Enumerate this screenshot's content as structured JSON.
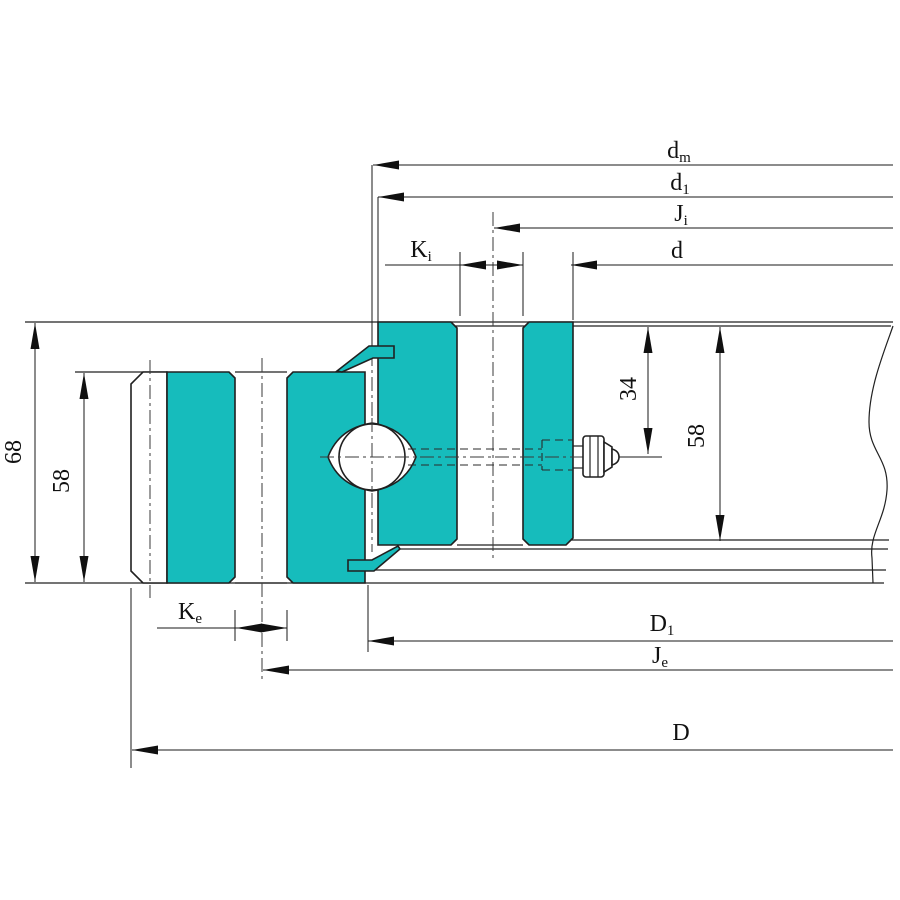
{
  "meta": {
    "title": "Slewing ring bearing cross-section drawing",
    "description": "Half-section engineering drawing of a single-row ball slewing bearing with teal inner and outer rings, rolling ball, top and bottom seals, grease fitting, mounting plates with break line, and diameter/height dimensions."
  },
  "colors": {
    "ring": "#16bcbc",
    "line": "#202020",
    "dim": "#1a1a1a",
    "bg": "#ffffff"
  },
  "dims": {
    "dm": {
      "main": "d",
      "sub": "m"
    },
    "d1": {
      "main": "d",
      "sub": "1"
    },
    "Ji": {
      "main": "J",
      "sub": "i"
    },
    "Ki": {
      "main": "K",
      "sub": "i"
    },
    "d": {
      "main": "d",
      "sub": ""
    },
    "D1": {
      "main": "D",
      "sub": "1"
    },
    "Je": {
      "main": "J",
      "sub": "e"
    },
    "D": {
      "main": "D",
      "sub": ""
    },
    "Ke": {
      "main": "K",
      "sub": "e"
    },
    "total_height": "68",
    "outer_ring_height": "58",
    "grease_port_center_offset": "34",
    "inner_ring_height": "58"
  }
}
